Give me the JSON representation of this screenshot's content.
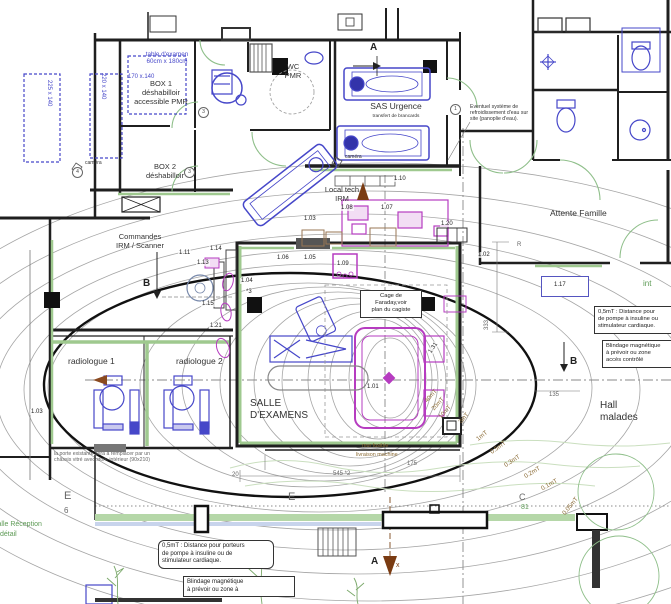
{
  "meta": {
    "type": "architectural floor plan",
    "subject": "IRM (MRI) suite plan with magnetic fringe-field contours"
  },
  "colors": {
    "wall": "#1f1f1f",
    "furniture_blue": "#4647c9",
    "equipment_magenta": "#b63cc0",
    "accent_green": "#9fc98f",
    "contour_gray": "#9a9a9a",
    "label_olive": "#8a6a34",
    "arrow_brown": "#7a3b12"
  },
  "rooms": {
    "box1": "BOX 1\ndéshabilloir\naccessible PMR",
    "box2": "BOX 2\ndéshabilloir",
    "wc_pmr": "WC\nPMR",
    "sas_urgence": "SAS Urgence",
    "sas_urgence_sub": "transfert de brancards",
    "local_tech": "Local tech\nIRM",
    "commandes": "Commandes\nIRM / Scanner",
    "attente": "Attente Famille",
    "salle": "SALLE\nD'EXAMENS",
    "radiologue1": "radiologue 1",
    "radiologue2": "radiologue 2",
    "hall": "Hall\nmalades",
    "reception": "salle Réception",
    "reception_detail": "détail",
    "int_partial": "int"
  },
  "notes": {
    "table_examen": "table d'examen\n60cm x 180cm",
    "eventuel": "Eventuel système de\nrefroidissement d'eau sur\nsite (panoplie d'eau).",
    "cage_faraday": "Cage de\nFaraday,voir\nplan du cagiste",
    "mt05_right": "0,5mT : Distance pour\nde pompe à insuline ou\nstimulateur cardiaque.",
    "blindage_right": "Blindage magnétique\nà prévoir ou zone\naccès contrôlé",
    "mt05_bottom": "0,5mT : Distance pour porteurs\nde pompe à insuline ou de\nstimulateur cardiaque.",
    "blindage_bottom": "Blindage magnétique\nà prévoir ou zone à",
    "porte": "la porte existante sera à remplacer par un\nchâssis vitré avec store intérieur (90x210)",
    "mur_fusible": "mur fusible",
    "livraison": "livraison machine",
    "camera": "caméra"
  },
  "equipment_numbers": {
    "n101": "1.01",
    "n102": "1.02",
    "n103": "1.03",
    "n104": "1.04",
    "n105": "1.05",
    "n106": "1.06",
    "n107": "1.07",
    "n108": "1.08",
    "n109": "1.09",
    "n110": "1.10",
    "n111": "1.11",
    "n113": "1.13",
    "n114": "1.14",
    "n115": "1.15",
    "n117": "1.17",
    "n120": "1.20",
    "n121": "1.21",
    "n131": "1.31",
    "star3": "*3"
  },
  "contour_labels": {
    "c40": "40mT",
    "c20": "20mT",
    "c10": "10mT",
    "c3": "3mT",
    "c1": "1mT",
    "c05": "0.5mT",
    "c03": "0.3mT",
    "c02": "0.2mT",
    "c01": "0.1mT",
    "c005": "0.05mT"
  },
  "markers": {
    "a": "A",
    "b": "B",
    "c": "C",
    "e": "E",
    "x": "x",
    "six": "6",
    "n81": "81",
    "r": "R"
  },
  "circled": {
    "one": "1",
    "three": "3",
    "four": "4"
  },
  "dimensions": {
    "d220": "220 x 140",
    "d225": "225 x 140",
    "d170": "170 x.140",
    "d333": "333",
    "d135": "135",
    "d20": "20",
    "d545": "545 *2",
    "d175": "175"
  }
}
